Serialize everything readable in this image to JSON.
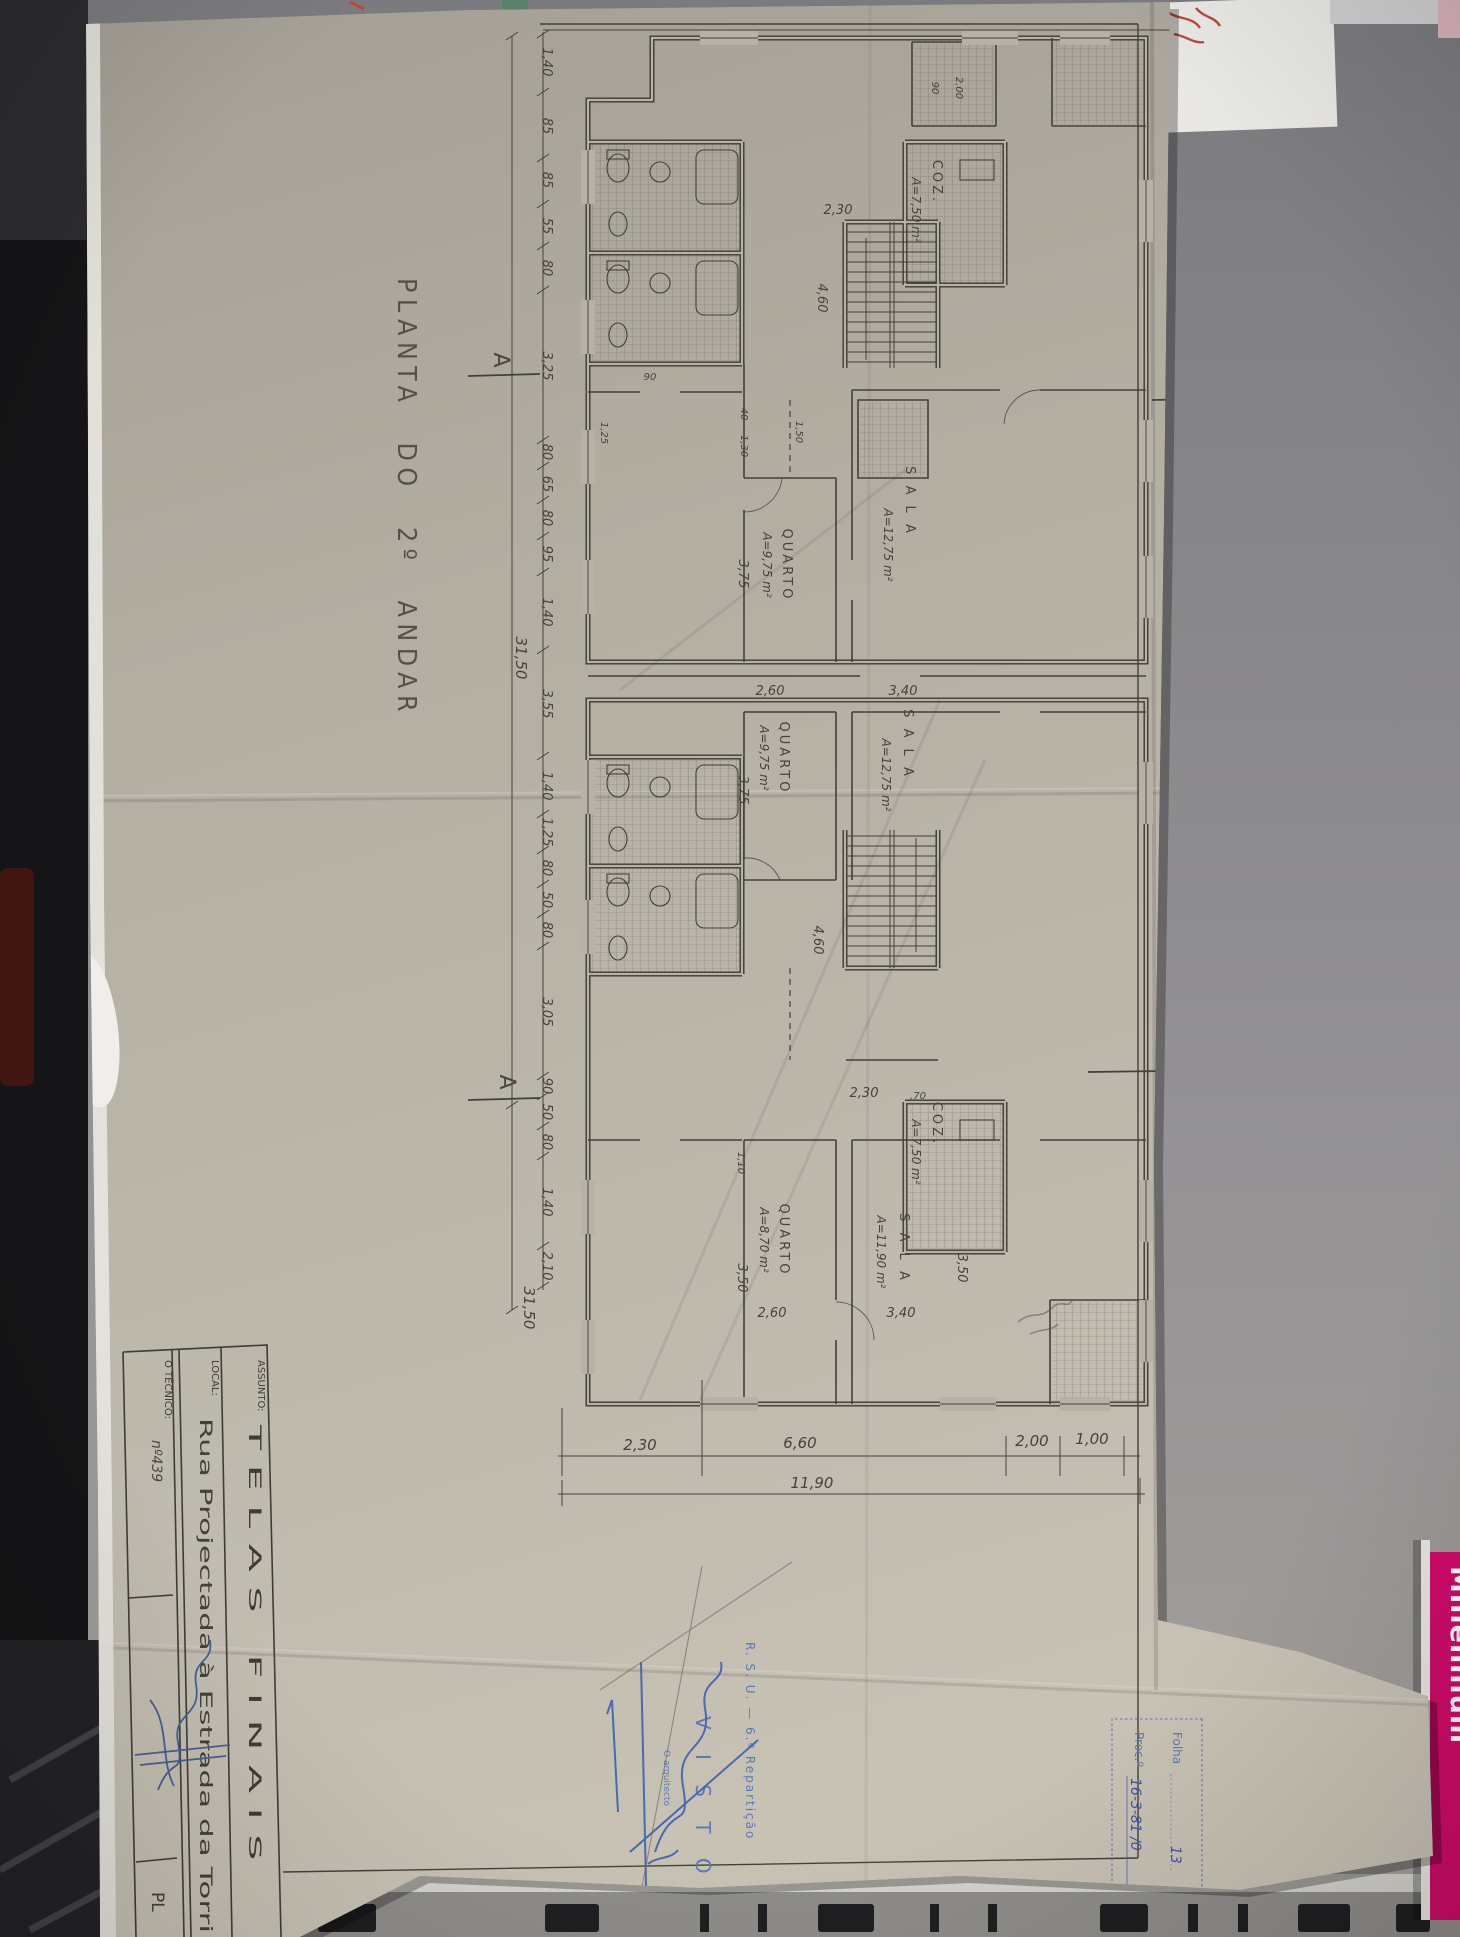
{
  "desk": {
    "millennium": "Millennium"
  },
  "sheet": {
    "title": "PLANTA DO 2º ANDAR",
    "markers": {
      "a_top": "A",
      "a_bottom": "A",
      "b_top": "B",
      "b_bottom": "B"
    },
    "rooms": [
      {
        "name": "QUARTO",
        "area": "A=9,75 m²"
      },
      {
        "name": "SALA",
        "area": "A=12,75 m²"
      },
      {
        "name": "COZ.",
        "area": "A=7,50 m²"
      },
      {
        "name": "QUARTO",
        "area": "A=9,75 m²"
      },
      {
        "name": "SALA",
        "area": "A=12,75 m²"
      },
      {
        "name": "QUARTO",
        "area": "A=8,70 m²"
      },
      {
        "name": "SALA",
        "area": "A=11,90 m²"
      },
      {
        "name": "COZ.",
        "area": "A=7,50 m²"
      }
    ],
    "dims": {
      "left": [
        "1,40",
        "85",
        "85",
        "55",
        "80",
        "3,25",
        "80",
        "65",
        "80",
        "95",
        "1,40",
        "3,55",
        "1,40",
        "1,25",
        "80",
        "50",
        "80",
        "3,05",
        "90",
        "50",
        "80",
        "1,40",
        "2,10"
      ],
      "left_total": "31,50",
      "left_total2": "31,50",
      "right": [
        "1,40",
        "1,90",
        "1,20",
        "2,05",
        "1,20",
        "1,85",
        "1,00",
        "1,40",
        "2,80",
        "1,40",
        "1,25",
        "1,45",
        "1,20",
        "2,00",
        "2,40",
        "85",
        "1,40",
        "1,25"
      ],
      "right_total": "31,50",
      "bottom": [
        "2,30",
        "6,60",
        "2,00",
        "1,00"
      ],
      "bottom_total": "11,90",
      "interior": [
        "1,30",
        "40",
        "3,75",
        "2,60",
        "3,40",
        "2,30",
        "4,60",
        "2,30",
        ",70",
        "4,60",
        "1,10",
        "3,50",
        "3,50",
        "2,60",
        "3,40",
        "3,75",
        "1,25",
        "90",
        "1,50",
        "2,00",
        "90"
      ]
    },
    "title_block": {
      "assunto_label": "ASSUNTO:",
      "assunto_value": "TELAS FINAIS",
      "local_label": "LOCAL:",
      "local_value": "Rua Projectada à Estrada da Torri",
      "tecnico_label": "O TÉCNICO:",
      "tecnico_note": "nº439",
      "corner_label": "PL"
    },
    "stamps": {
      "folha_label": "Folha",
      "folha_value": "13",
      "proc_label": "Proc.º",
      "proc_value": "16-3-81 /0",
      "rsu_line": "R. S. U. — 6.ª Repartição",
      "visto": "V I S T O",
      "visto_sub": "O arquitecto"
    }
  }
}
